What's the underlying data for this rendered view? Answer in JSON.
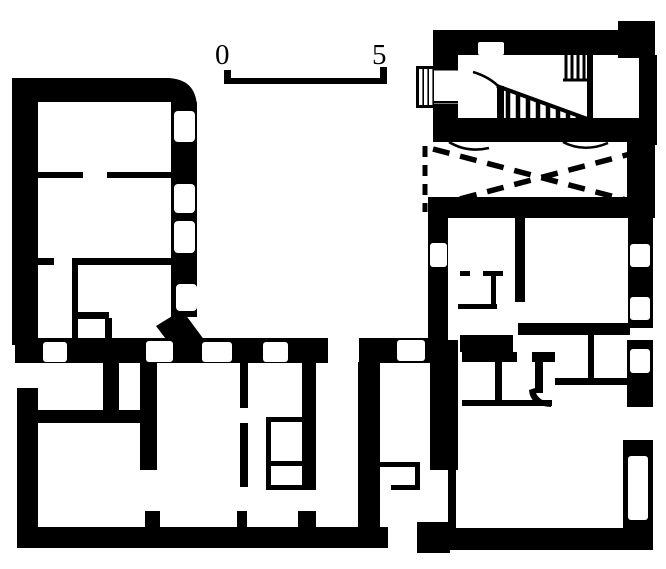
{
  "page": {
    "title": "Architectural floor plan (scanned line drawing)",
    "paper_color": "#ffffff",
    "ink_color": "#000000"
  },
  "scale_bar": {
    "start_label": "0",
    "end_label": "5"
  },
  "plan": {
    "regions": [
      {
        "id": "left-wing",
        "label": "left wing with four windows and partitioned rooms"
      },
      {
        "id": "bottom-range",
        "label": "bottom range of rooms with window openings"
      },
      {
        "id": "stair-hall",
        "label": "stair hall with hatched staircase and entrance steps"
      },
      {
        "id": "crossed-room",
        "label": "room crossed out with dashed X and dashed wall"
      },
      {
        "id": "right-wing",
        "label": "right wing with rooms, closets and windows"
      }
    ],
    "symbols": [
      {
        "id": "wall",
        "meaning": "solid black band"
      },
      {
        "id": "window",
        "meaning": "white inset in wall"
      },
      {
        "id": "door-opening",
        "meaning": "gap in wall"
      },
      {
        "id": "staircase",
        "meaning": "hatched triangle of steps"
      },
      {
        "id": "dashed-x",
        "meaning": "dashed diagonal cross over room"
      }
    ]
  }
}
